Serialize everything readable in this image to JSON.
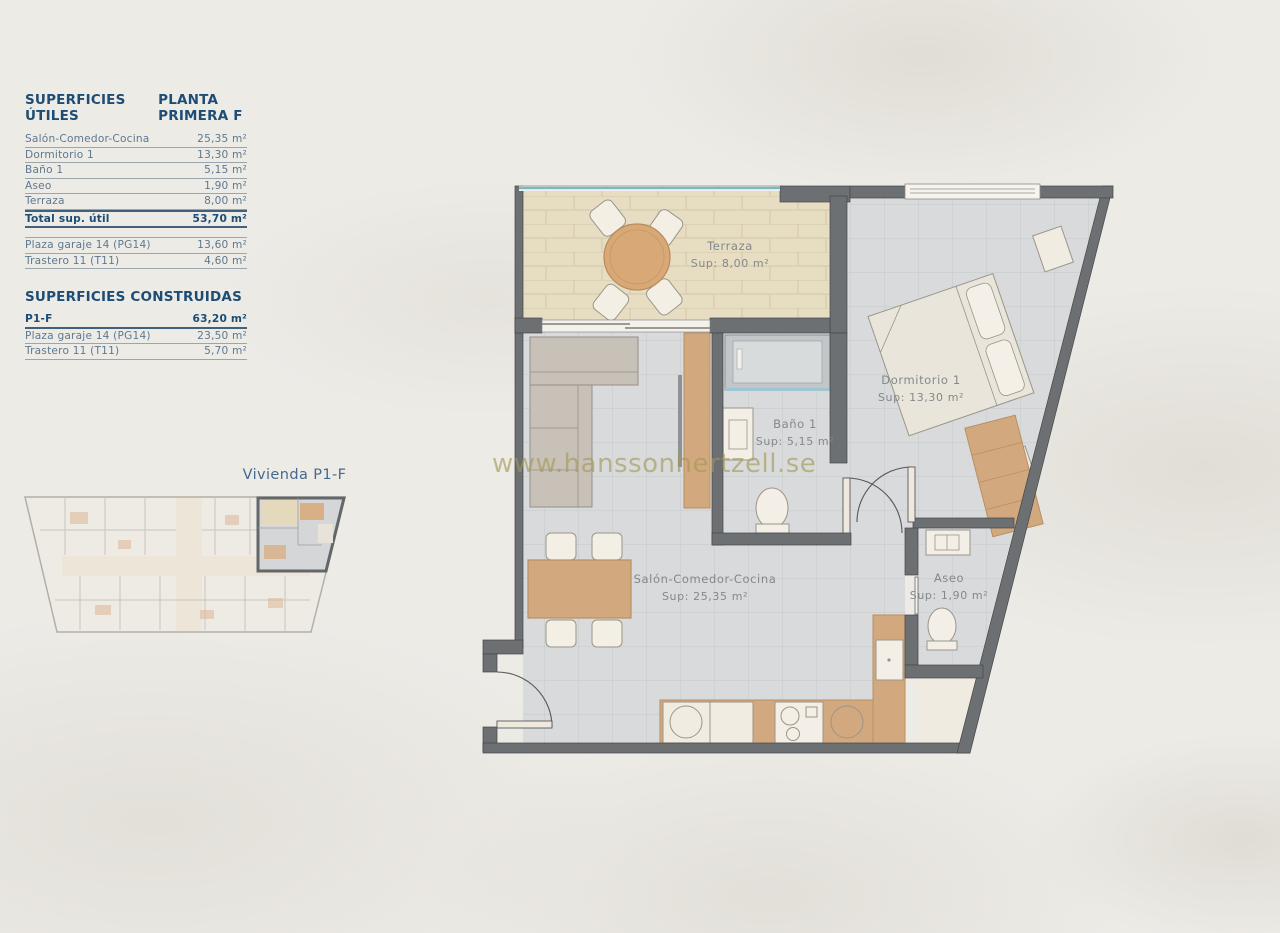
{
  "surfaces": {
    "utiles": {
      "title": "SUPERFICIES ÚTILES",
      "subtitle": "PLANTA PRIMERA F",
      "rows": [
        {
          "label": "Salón-Comedor-Cocina",
          "value": "25,35 m²"
        },
        {
          "label": "Dormitorio 1",
          "value": "13,30 m²"
        },
        {
          "label": "Baño 1",
          "value": "5,15 m²"
        },
        {
          "label": "Aseo",
          "value": "1,90 m²"
        },
        {
          "label": "Terraza",
          "value": "8,00 m²"
        }
      ],
      "total": {
        "label": "Total sup. útil",
        "value": "53,70 m²"
      },
      "extras": [
        {
          "label": "Plaza garaje 14 (PG14)",
          "value": "13,60 m²"
        },
        {
          "label": "Trastero 11 (T11)",
          "value": "4,60 m²"
        }
      ]
    },
    "construidas": {
      "title": "SUPERFICIES CONSTRUIDAS",
      "rows": [
        {
          "label": "P1-F",
          "value": "63,20 m²"
        },
        {
          "label": "Plaza garaje 14 (PG14)",
          "value": "23,50 m²"
        },
        {
          "label": "Trastero 11 (T11)",
          "value": "5,70 m²"
        }
      ]
    }
  },
  "overview": {
    "label": "Vivienda P1-F"
  },
  "floorplan": {
    "rooms": {
      "terraza": {
        "name": "Terraza",
        "sup": "Sup: 8,00 m²"
      },
      "dormitorio": {
        "name": "Dormitorio 1",
        "sup": "Sup: 13,30 m²"
      },
      "bano": {
        "name": "Baño 1",
        "sup": "Sup: 5,15 m²"
      },
      "salon": {
        "name": "Salón-Comedor-Cocina",
        "sup": "Sup: 25,35 m²"
      },
      "aseo": {
        "name": "Aseo",
        "sup": "Sup: 1,90 m²"
      }
    }
  },
  "watermark": "www.hanssonhertzell.se",
  "colors": {
    "heading_blue": "#1d4c74",
    "table_text_blue": "#5e7890",
    "wall_gray": "#6d7073",
    "floor_tile": "#d8dadb",
    "terrace_tile": "#e7ddc2",
    "wood": "#d2a97e",
    "glass_teal": "#7fb6c6",
    "watermark_olive": "#a39854",
    "background": "#edebe6"
  }
}
